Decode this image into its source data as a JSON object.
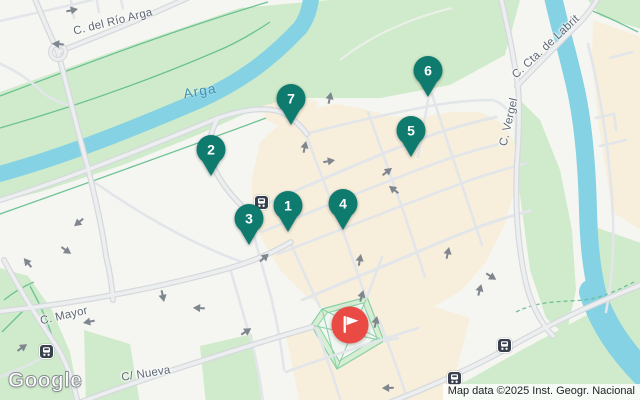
{
  "map": {
    "provider_logo": "Google",
    "attribution_text": "Map data ©2025 Inst. Geogr. Nacional",
    "labels": {
      "rio_arga": "C. del Río Arga",
      "arga_river": "Arga",
      "labrit": "C. Cta. de Labrit",
      "vergel": "C. Vergel",
      "mayor": "C. Mayor",
      "nueva": "C/ Nueva"
    },
    "colors": {
      "marker": "#0f7b6e",
      "destination": "#e94b44",
      "water": "#85d2e4",
      "park": "#d0ebcb",
      "building": "#f7efdc",
      "road_fill": "#eceef0",
      "road_casing": "#d5d8dc",
      "arrow": "#7f868e",
      "transit_bg": "#39404d"
    },
    "icons": {
      "transit": "transit-station-icon",
      "destination": "flag-icon"
    },
    "markers": [
      {
        "label": "1",
        "x": 288,
        "y": 233
      },
      {
        "label": "2",
        "x": 211,
        "y": 177
      },
      {
        "label": "3",
        "x": 249,
        "y": 246
      },
      {
        "label": "4",
        "x": 343,
        "y": 231
      },
      {
        "label": "5",
        "x": 411,
        "y": 158
      },
      {
        "label": "6",
        "x": 428,
        "y": 98
      },
      {
        "label": "7",
        "x": 291,
        "y": 126
      }
    ],
    "destination_marker": {
      "x": 350,
      "y": 325
    },
    "transit_stops": [
      {
        "x": 262,
        "y": 203
      },
      {
        "x": 47,
        "y": 352
      },
      {
        "x": 505,
        "y": 346
      },
      {
        "x": 455,
        "y": 379
      }
    ],
    "arrows": [
      {
        "x": 73,
        "y": 10,
        "r": -12
      },
      {
        "x": 57,
        "y": 44,
        "r": 185
      },
      {
        "x": 330,
        "y": 97,
        "r": -78
      },
      {
        "x": 305,
        "y": 146,
        "r": -78
      },
      {
        "x": 330,
        "y": 161,
        "r": -10
      },
      {
        "x": 388,
        "y": 171,
        "r": -38
      },
      {
        "x": 393,
        "y": 189,
        "r": -142
      },
      {
        "x": 78,
        "y": 223,
        "r": 140
      },
      {
        "x": 67,
        "y": 251,
        "r": 35
      },
      {
        "x": 27,
        "y": 262,
        "r": -130
      },
      {
        "x": 88,
        "y": 322,
        "r": 168
      },
      {
        "x": 163,
        "y": 297,
        "r": 78
      },
      {
        "x": 198,
        "y": 308,
        "r": 183
      },
      {
        "x": 247,
        "y": 331,
        "r": -32
      },
      {
        "x": 265,
        "y": 257,
        "r": -42
      },
      {
        "x": 23,
        "y": 347,
        "r": -35
      },
      {
        "x": 360,
        "y": 259,
        "r": -80
      },
      {
        "x": 448,
        "y": 252,
        "r": -78
      },
      {
        "x": 492,
        "y": 277,
        "r": 32
      },
      {
        "x": 480,
        "y": 289,
        "r": -75
      },
      {
        "x": 387,
        "y": 388,
        "r": 178
      },
      {
        "x": 362,
        "y": 295,
        "r": -75
      },
      {
        "x": 376,
        "y": 321,
        "r": -78
      }
    ]
  }
}
